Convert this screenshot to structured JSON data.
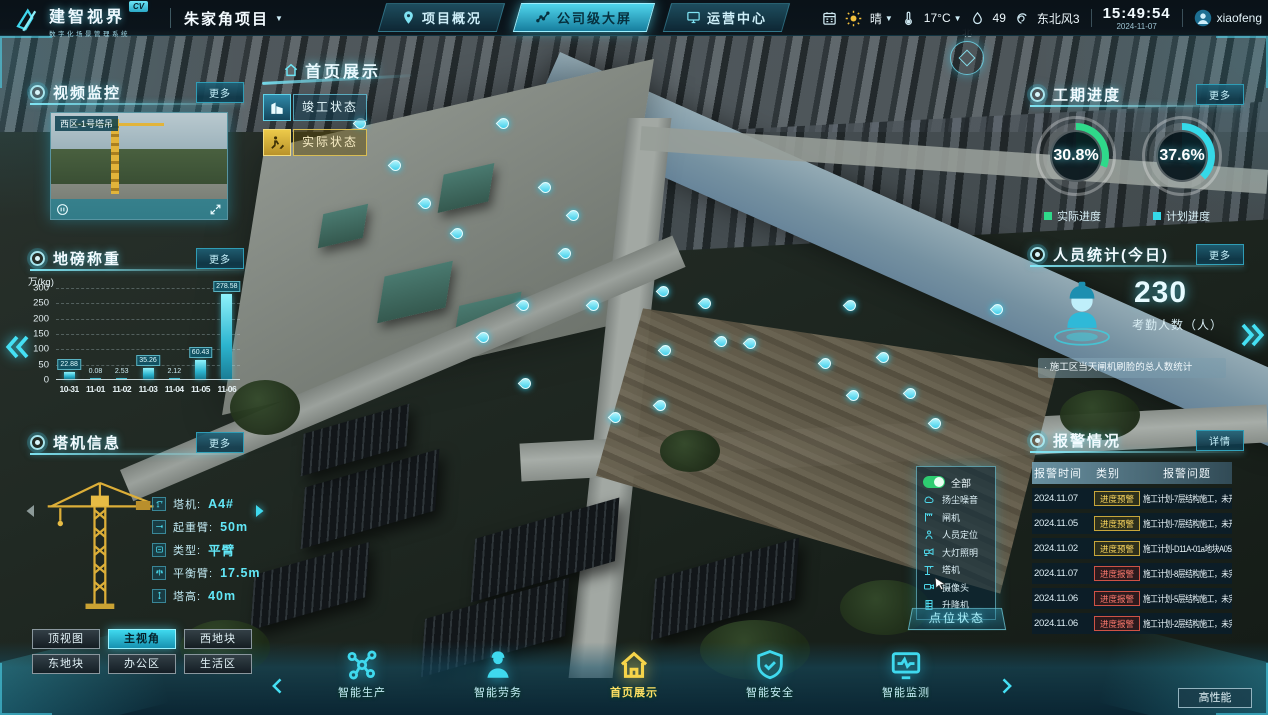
{
  "top_bar": {
    "logo": {
      "title": "建智视界",
      "badge": "CV",
      "subtitle": "数字化场景管理系统"
    },
    "project": {
      "name": "朱家角项目"
    },
    "tabs": [
      {
        "label": "项目概况",
        "icon": "location-pin-icon",
        "active": false
      },
      {
        "label": "公司级大屏",
        "icon": "line-chart-icon",
        "active": true
      },
      {
        "label": "运营中心",
        "icon": "monitor-icon",
        "active": false
      }
    ],
    "status": {
      "condition": "晴",
      "temperature": "17°C",
      "humidity": "49",
      "wind": "东北风3",
      "time": "15:49:54",
      "date": "2024-11-07",
      "user": "xiaofeng"
    }
  },
  "map": {
    "page_title": "首页展示",
    "compass_label": "北",
    "state_buttons": [
      {
        "label": "竣工状态",
        "icon": "building-icon",
        "theme": "cyan"
      },
      {
        "label": "实际状态",
        "icon": "construction-icon",
        "theme": "yellow"
      }
    ]
  },
  "panels": {
    "video": {
      "title": "视频监控",
      "more_label": "更多",
      "camera_label": "西区-1号塔吊"
    },
    "weighbridge": {
      "title": "地磅称重",
      "more_label": "更多"
    },
    "crane": {
      "title": "塔机信息",
      "more_label": "更多",
      "fields": [
        {
          "icon": "crane-icon",
          "label": "塔机:",
          "value": "A4#"
        },
        {
          "icon": "jib-icon",
          "label": "起重臂:",
          "value": "50m"
        },
        {
          "icon": "type-icon",
          "label": "类型:",
          "value": "平臂"
        },
        {
          "icon": "balance-icon",
          "label": "平衡臂:",
          "value": "17.5m"
        },
        {
          "icon": "height-icon",
          "label": "塔高:",
          "value": "40m"
        }
      ]
    },
    "progress": {
      "title": "工期进度",
      "more_label": "更多",
      "gauges": [
        {
          "value": 30.8,
          "display": "30.8%",
          "legend": "实际进度",
          "color": "#2fd98a"
        },
        {
          "value": 37.6,
          "display": "37.6%",
          "legend": "计划进度",
          "color": "#35d9e8"
        }
      ]
    },
    "personnel": {
      "title": "人员统计(今日)",
      "more_label": "更多",
      "count": "230",
      "count_label": "考勤人数（人）",
      "note": "· 施工区当天闸机刷脸的总人数统计"
    },
    "alarm": {
      "title": "报警情况",
      "detail_label": "详情",
      "headers": [
        "报警时间",
        "类别",
        "报警问题"
      ],
      "rows": [
        {
          "time": "2024.11.07",
          "badge": "进度预警",
          "type": "warn",
          "issue": "施工计划-7层结构施工，未开始"
        },
        {
          "time": "2024.11.05",
          "badge": "进度预警",
          "type": "warn",
          "issue": "施工计划-7层结构施工，未开始"
        },
        {
          "time": "2024.11.02",
          "badge": "进度预警",
          "type": "warn",
          "issue": "施工计划-D11A-01a地块A05#…"
        },
        {
          "time": "2024.11.07",
          "badge": "进度报警",
          "type": "alert",
          "issue": "施工计划-8层结构施工，未完成"
        },
        {
          "time": "2024.11.06",
          "badge": "进度报警",
          "type": "alert",
          "issue": "施工计划-5层结构施工，未完成"
        },
        {
          "time": "2024.11.06",
          "badge": "进度报警",
          "type": "alert",
          "issue": "施工计划-2层结构施工，未完成"
        }
      ]
    }
  },
  "legend_panel": {
    "all_label": "全部",
    "items": [
      {
        "icon": "dust-noise-icon",
        "label": "扬尘噪音"
      },
      {
        "icon": "gate-icon",
        "label": "闸机"
      },
      {
        "icon": "person-locate-icon",
        "label": "人员定位"
      },
      {
        "icon": "floodlight-icon",
        "label": "大灯照明"
      },
      {
        "icon": "tower-crane-icon",
        "label": "塔机"
      },
      {
        "icon": "camera-icon",
        "label": "摄像头"
      },
      {
        "icon": "hoist-icon",
        "label": "升降机"
      }
    ],
    "footer_label": "点位状态"
  },
  "view_buttons": [
    {
      "label": "顶视图",
      "active": false
    },
    {
      "label": "主视角",
      "active": true
    },
    {
      "label": "西地块",
      "active": false
    },
    {
      "label": "东地块",
      "active": false
    },
    {
      "label": "办公区",
      "active": false
    },
    {
      "label": "生活区",
      "active": false
    }
  ],
  "bottom_nav": {
    "items": [
      {
        "label": "智能生产",
        "icon": "production-icon",
        "active": false
      },
      {
        "label": "智能劳务",
        "icon": "labor-icon",
        "active": false
      },
      {
        "label": "首页展示",
        "icon": "home-icon",
        "active": true
      },
      {
        "label": "智能安全",
        "icon": "security-icon",
        "active": false
      },
      {
        "label": "智能监测",
        "icon": "monitoring-icon",
        "active": false
      }
    ]
  },
  "perf_button_label": "高性能",
  "chart_data": {
    "type": "bar",
    "title": "地磅称重",
    "ylabel": "万(kg)",
    "categories": [
      "10-31",
      "11-01",
      "11-02",
      "11-03",
      "11-04",
      "11-05",
      "11-06"
    ],
    "values": [
      22.88,
      0.08,
      2.53,
      35.26,
      2.12,
      60.43,
      278.58
    ],
    "ylim": [
      0,
      300
    ],
    "yticks": [
      0,
      50,
      100,
      150,
      200,
      250,
      300
    ],
    "bar_color": "#35d9e8",
    "grid": true
  }
}
